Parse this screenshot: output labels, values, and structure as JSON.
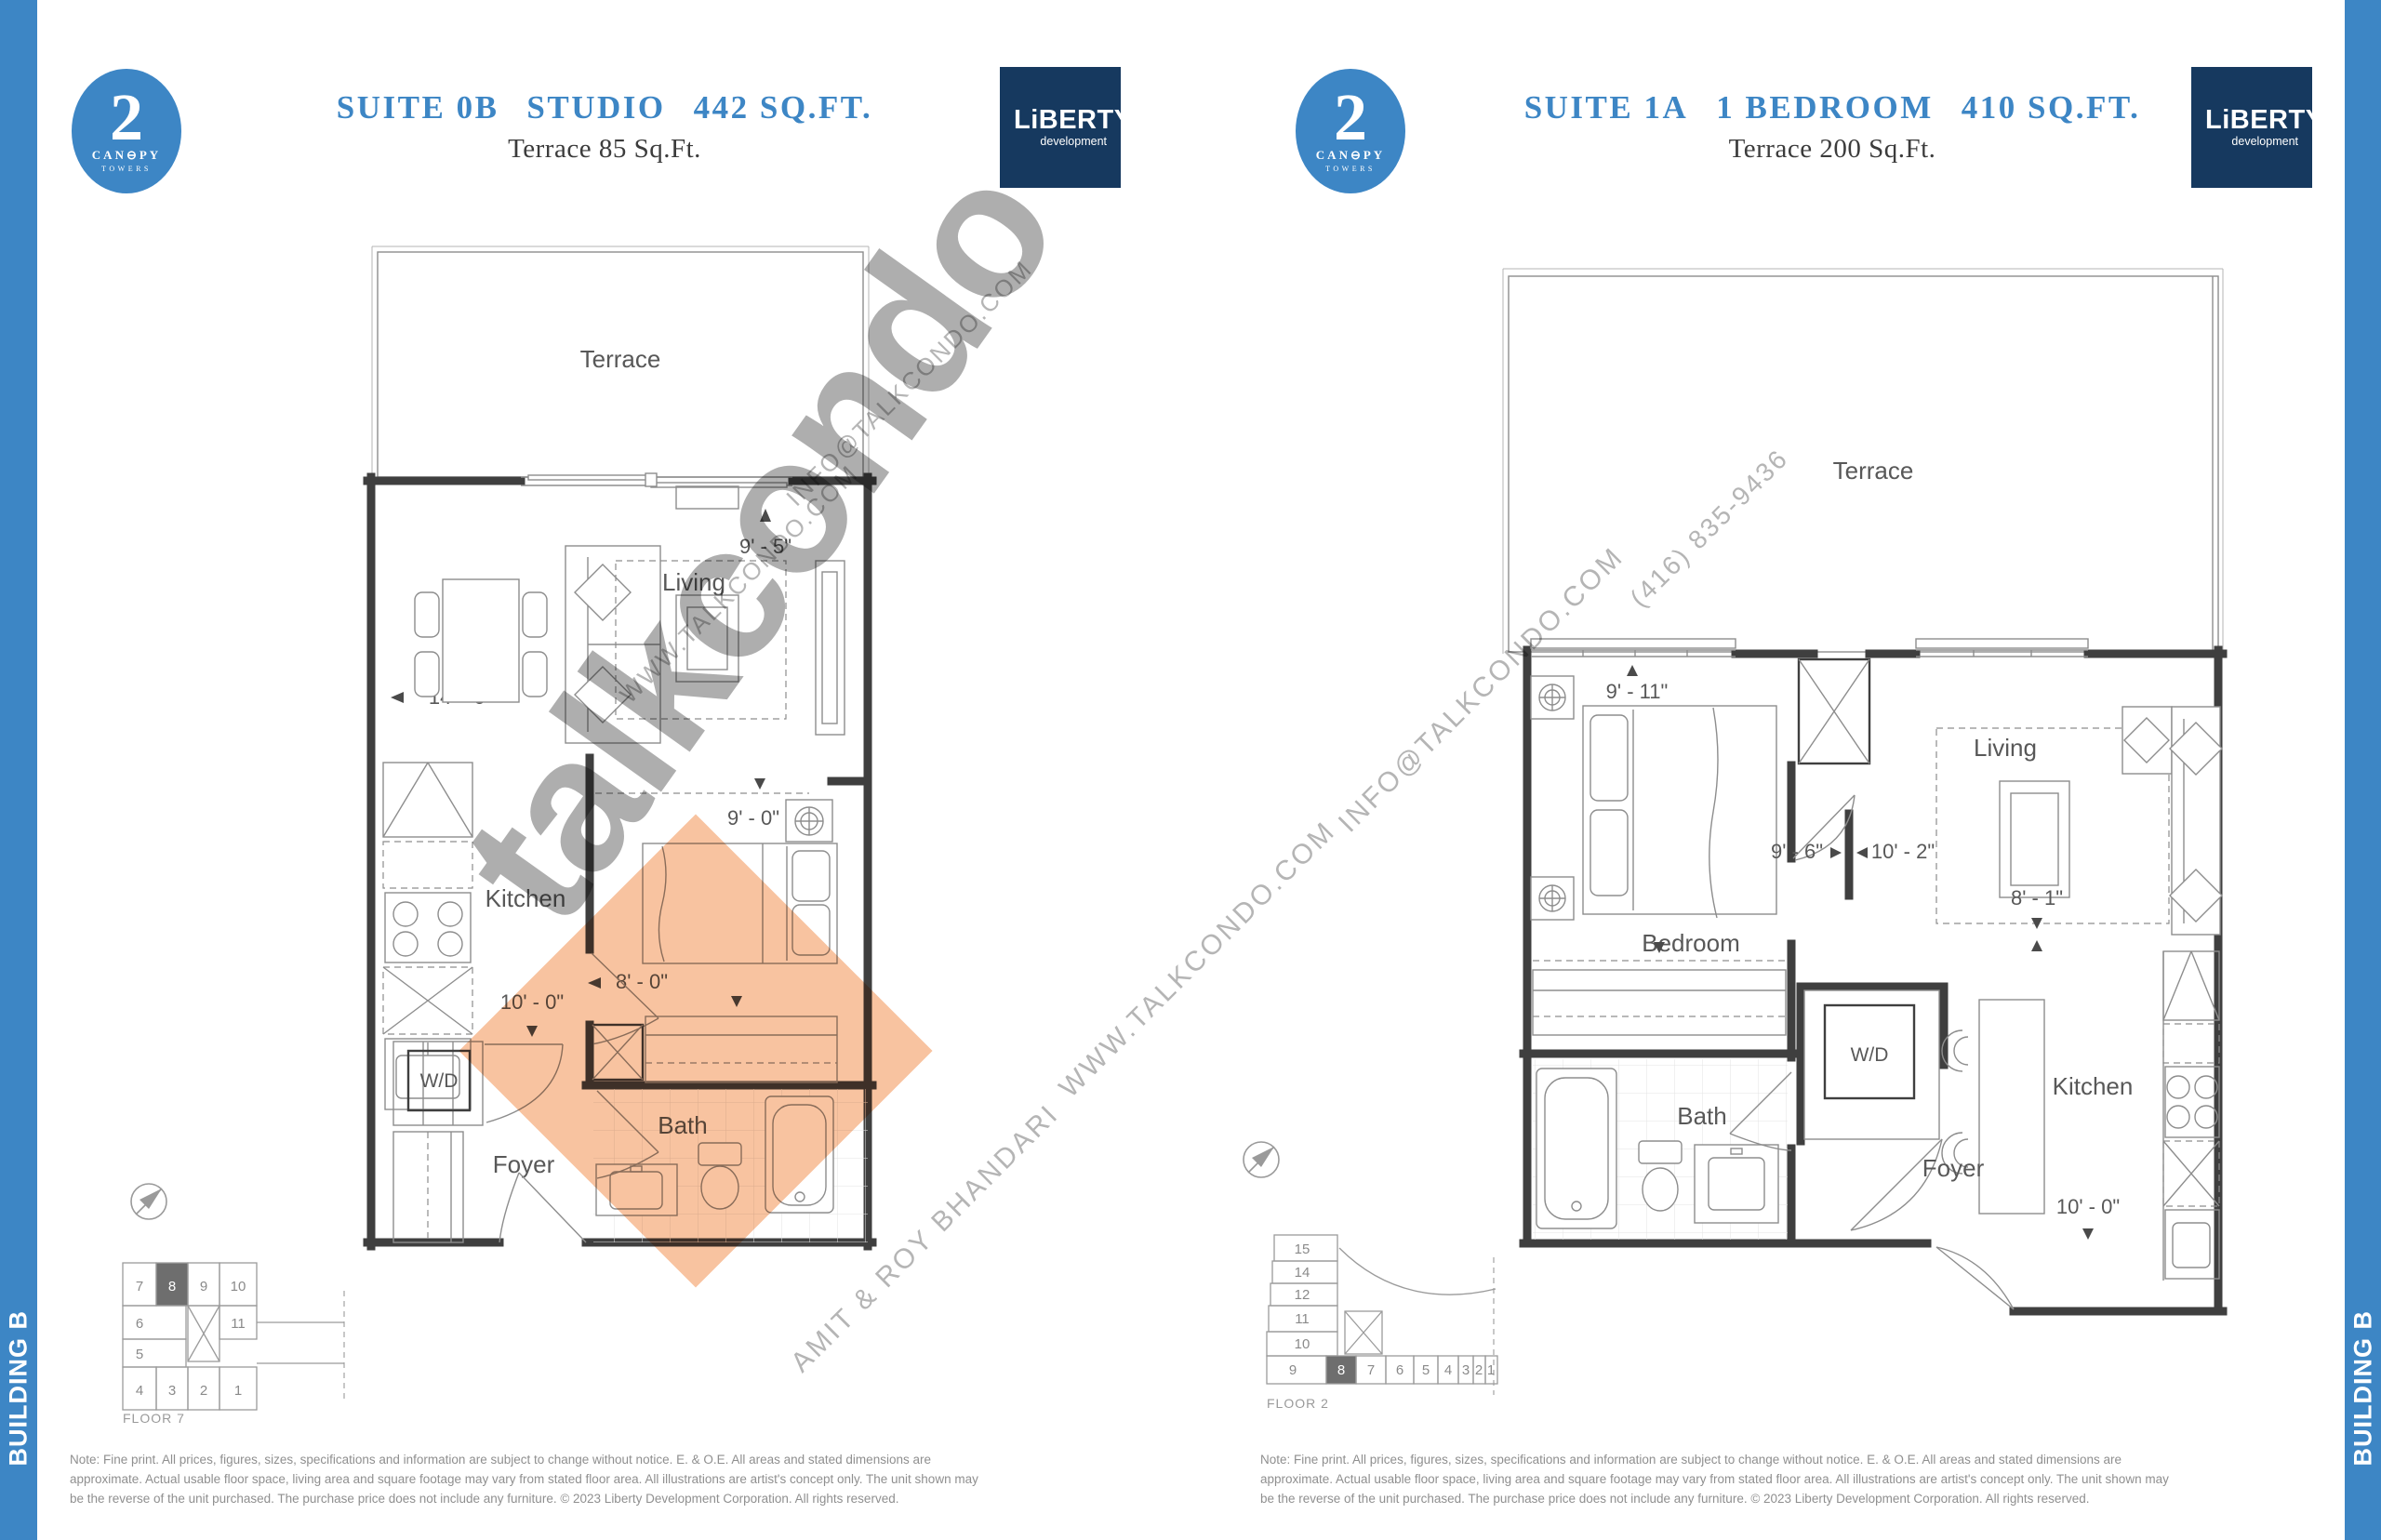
{
  "colors": {
    "accent": "#3d86c5",
    "navy": "#16395f",
    "wall": "#3f3f3f",
    "line": "#8d8d8d",
    "label": "#585858",
    "watermark": "#aeaeae",
    "watermark_small": "#b5b5b5",
    "diamond": "#f8c3a0",
    "note": "#8f8f8f",
    "keyplan": "#9b9b9b",
    "keyplan_highlight": "#6e6e6e"
  },
  "page": {
    "building_label": "BUILDING B",
    "note": "Note: Fine print. All prices, figures, sizes, specifications and information are subject to change without notice. E. & O.E. All areas and stated dimensions are approximate. Actual usable floor space, living area and square footage may vary from stated floor area. All illustrations are artist's concept only. The unit shown may be the reverse of the unit purchased. The purchase price does not include any furniture. © 2023 Liberty Development Corporation. All rights reserved."
  },
  "brand": {
    "canopy_number": "2",
    "canopy_name": "CAN⊖PY",
    "canopy_sub": "TOWERS",
    "liberty_name": "LiBERTY",
    "liberty_sub": "development"
  },
  "watermark": {
    "big": "talkcondo",
    "www": "WWW.TALKCONDO.COM",
    "email": "INFO@TALKCONDO.COM",
    "phone": "(416) 835-9436",
    "agents": "AMIT & ROY BHANDARI"
  },
  "left": {
    "title": {
      "suite": "SUITE 0B",
      "type": "STUDIO",
      "area": "442 SQ.FT."
    },
    "subtitle": "Terrace 85 Sq.Ft.",
    "floor": "FLOOR 7",
    "labels": {
      "terrace": "Terrace",
      "living": "Living",
      "kitchen": "Kitchen",
      "wd": "W/D",
      "foyer": "Foyer",
      "bath": "Bath"
    },
    "dims": {
      "w1": "9' - 5\"",
      "w2": "14' - 6\"",
      "w3": "9' - 0\"",
      "w4": "8' - 0\"",
      "w5": "10' - 0\""
    },
    "keyplan": {
      "row1": [
        "7",
        "8",
        "9",
        "10"
      ],
      "row2": [
        "6",
        "11"
      ],
      "row3": [
        "5"
      ],
      "row4": [
        "4",
        "3",
        "2",
        "1"
      ],
      "highlight": "8"
    }
  },
  "right": {
    "title": {
      "suite": "SUITE 1A",
      "type": "1 BEDROOM",
      "area": "410 SQ.FT."
    },
    "subtitle": "Terrace 200 Sq.Ft.",
    "floor": "FLOOR 2",
    "labels": {
      "terrace": "Terrace",
      "bedroom": "Bedroom",
      "living": "Living",
      "kitchen": "Kitchen",
      "wd": "W/D",
      "foyer": "Foyer",
      "bath": "Bath"
    },
    "dims": {
      "w1": "9' - 11\"",
      "w2": "9' - 6\"",
      "w3": "10' - 2\"",
      "w4": "8' - 1\"",
      "w5": "10' - 0\""
    },
    "keyplan": {
      "col": [
        "15",
        "14",
        "12",
        "11",
        "10"
      ],
      "row": [
        "9",
        "8",
        "7",
        "6",
        "5",
        "4",
        "3",
        "2",
        "1"
      ],
      "highlight": "8"
    }
  }
}
